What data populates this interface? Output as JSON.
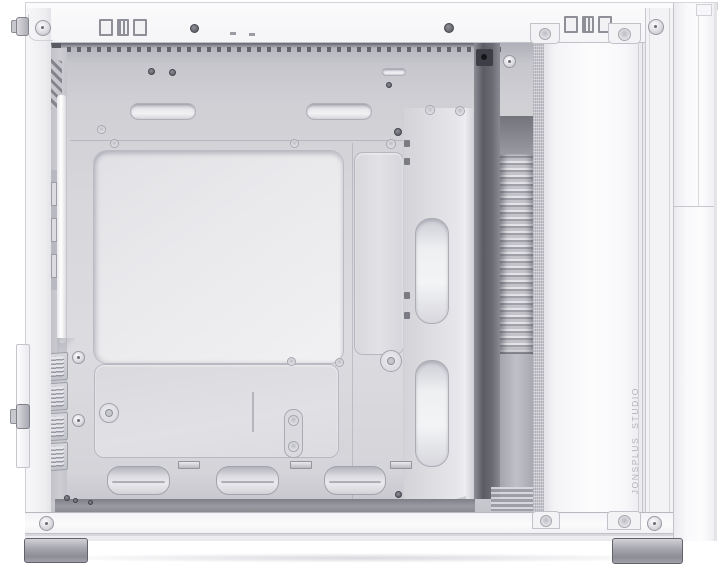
{
  "scene": {
    "subject": "White PC tower case, side view with side panel removed showing empty interior",
    "brand_vertical_text": "JONSPLUS STUDIO"
  },
  "counts": {
    "pci_slot_covers": 4,
    "top_cable_slots": 2,
    "side_cable_cutouts": 2,
    "bottom_cable_cutouts": 3,
    "case_feet": 2
  },
  "colors": {
    "frame_white": "#f5f5f7",
    "frame_line": "#c6c6cd",
    "wall_gray": "#c9c9cf",
    "tray_gray": "#d8d8dc",
    "cutout_bright": "#eeeef1",
    "gap_dark": "#62626a",
    "louver_dark": "#9a9aa2",
    "floor_dark": "#8e8e96",
    "brand_text_gray": "#b2b2b8",
    "foot_gray": "#a0a0a8"
  }
}
